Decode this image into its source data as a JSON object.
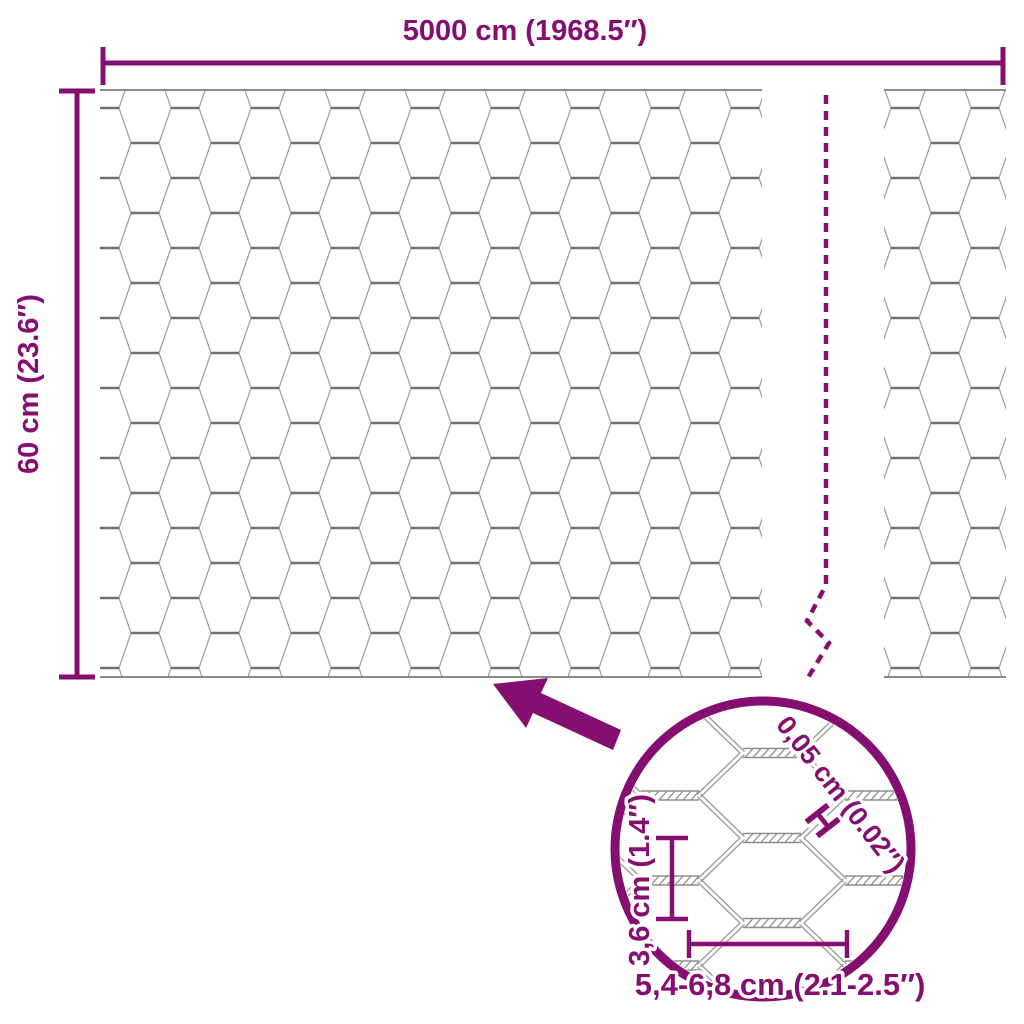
{
  "diagram_type": "product-dimension-diagram",
  "product": "hexagonal-wire-mesh-roll",
  "colors": {
    "accent": "#850F70",
    "wire": "#9a9a9a",
    "wire_dark": "#6f6f6f",
    "background": "#ffffff"
  },
  "labels": {
    "total_width": "5000 cm (1968.5″)",
    "roll_height": "60 cm (23.6″)"
  },
  "detail": {
    "wire_thickness": "0,05 cm (0.02″)",
    "thickness_symbol": "H",
    "mesh_height": "3,6 cm (1.4″)",
    "mesh_width_range": "5,4-6,8 cm (2.1-2.5″)"
  }
}
